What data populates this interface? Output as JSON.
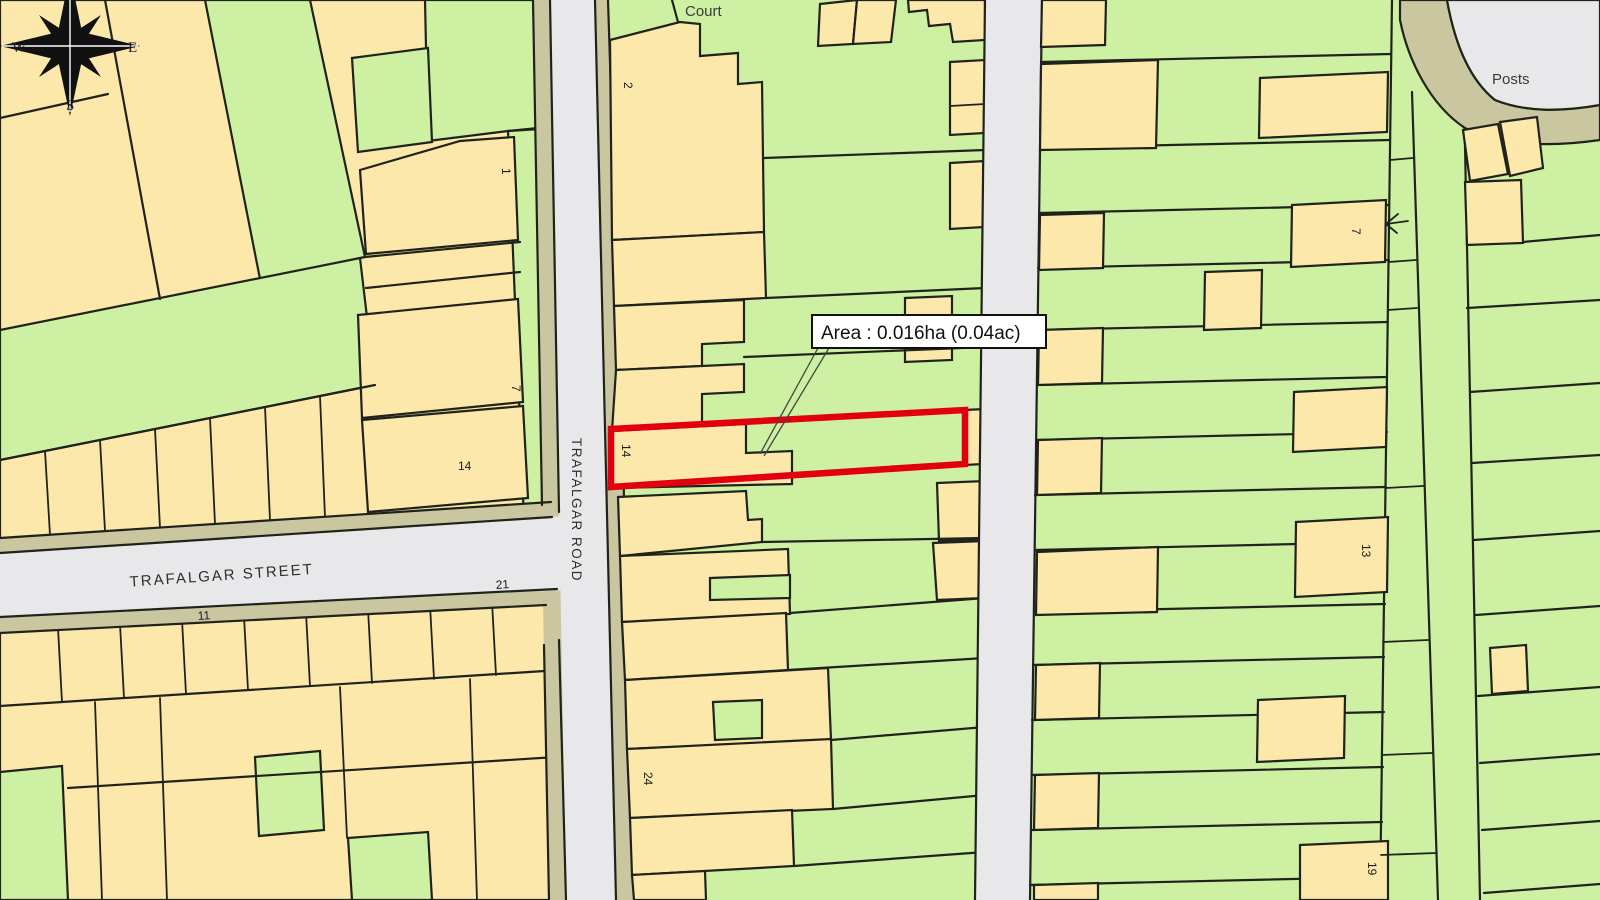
{
  "map": {
    "kind": "cadastral-title-plan",
    "labels": {
      "court": "Court",
      "posts": "Posts",
      "street_name": "TRAFALGAR STREET",
      "road_name": "TRAFALGAR ROAD",
      "area_annotation": "Area : 0.016ha (0.04ac)"
    },
    "compass": {
      "west": "W",
      "east": "E",
      "south": "S"
    },
    "plot_numbers": {
      "left_block_1": "1",
      "left_block_7": "7",
      "left_block_14": "14",
      "left_block_21": "21",
      "left_block_11": "11",
      "mid_block_2": "2",
      "highlight_14": "14",
      "mid_block_24": "24",
      "right_block_7": "7",
      "right_block_13": "13",
      "right_block_19": "19"
    },
    "colors": {
      "parcel_yellow": "#fbe8aa",
      "parcel_green": "#cdf0a2",
      "road_grey": "#e8e8ea",
      "pavement": "#cac7a0",
      "boundary": "#20231b",
      "highlight_red": "#e2000f",
      "annotation_bg": "#ffffff",
      "annotation_text": "#111111"
    }
  }
}
